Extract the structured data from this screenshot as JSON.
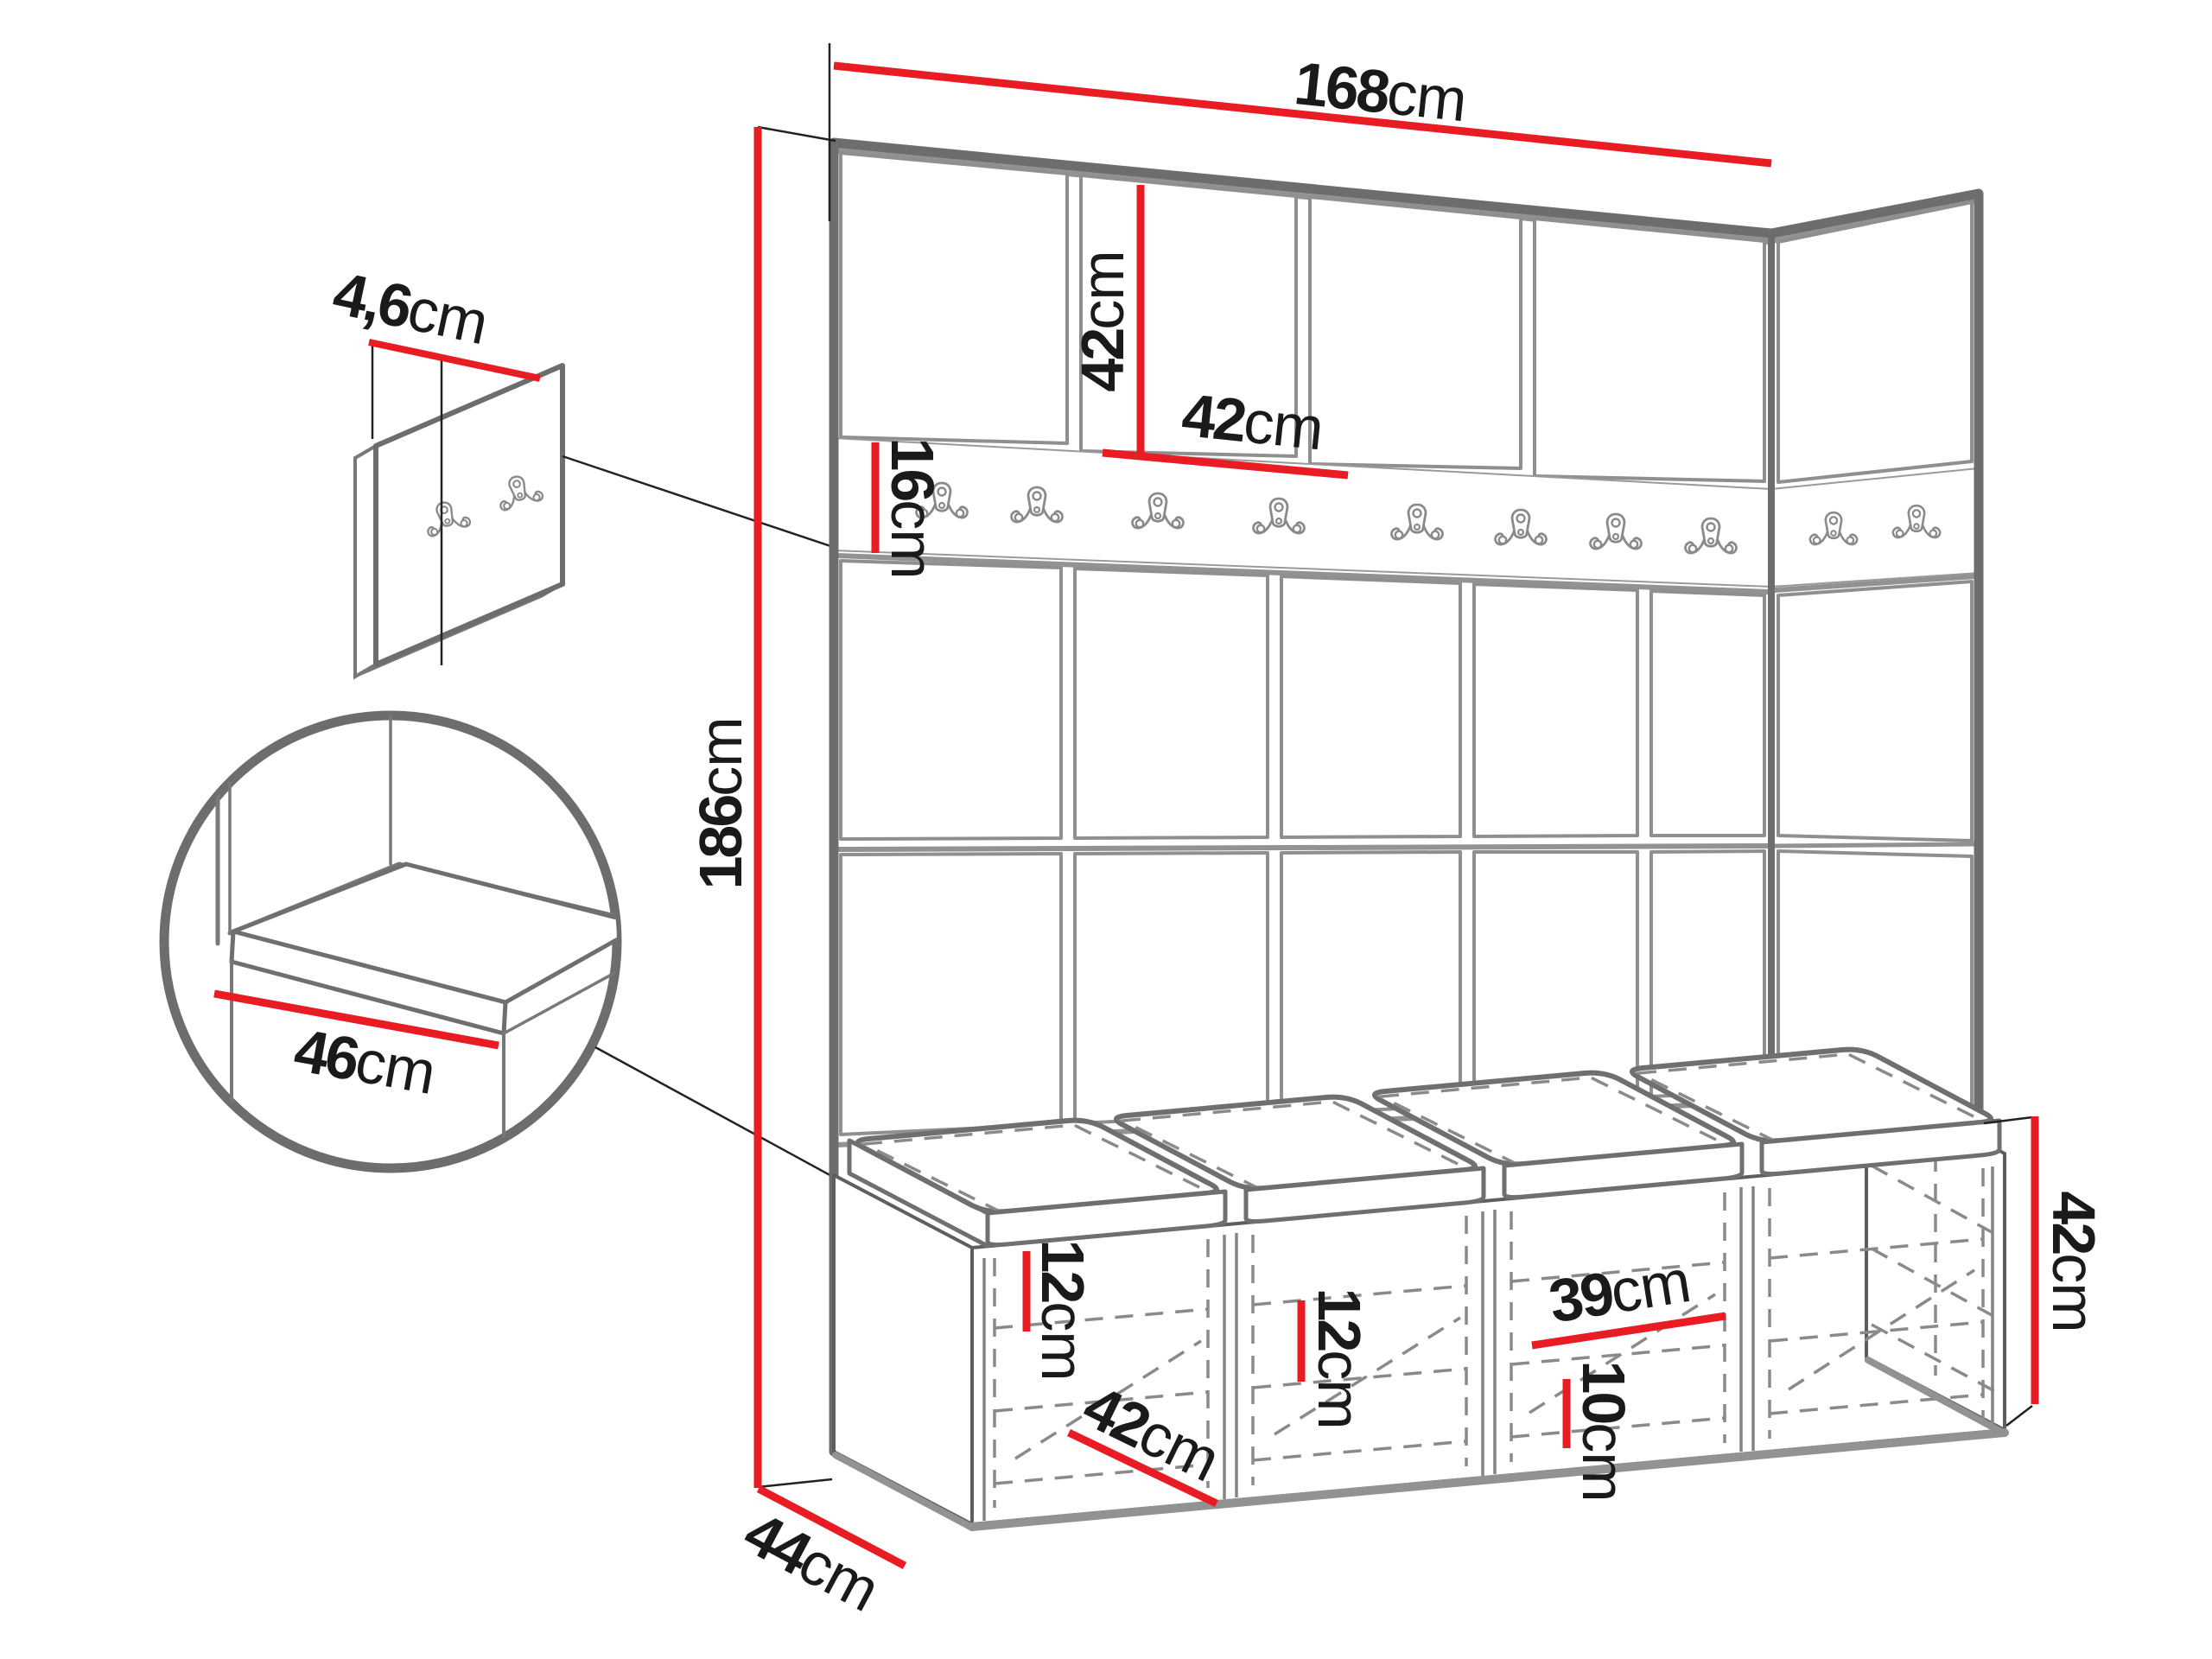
{
  "diagram": {
    "type": "furniture-dimension-drawing",
    "subject": "hallway wardrobe set with upholstered wall panels, hook rail, corner return and shoe storage bench",
    "unit": "cm"
  },
  "colors": {
    "dimension_red": "#e81c22",
    "outline_gray": "#8f8f8f",
    "frame_gray": "#6d6d6d",
    "cabinet_gray": "#5e5e5e",
    "dashed_gray": "#8a8a8a",
    "text_black": "#1a1a1a",
    "background": "#ffffff"
  },
  "counts": {
    "front_hooks": 8,
    "side_hooks": 2,
    "detail_panel_hooks": 2,
    "seat_cushions": 4,
    "storage_sections": 4
  },
  "dimensions": {
    "total_width": {
      "value": "168",
      "unit": "cm"
    },
    "total_height": {
      "value": "186",
      "unit": "cm"
    },
    "panel_height": {
      "value": "42",
      "unit": "cm"
    },
    "panel_width": {
      "value": "42",
      "unit": "cm"
    },
    "rail_height": {
      "value": "16",
      "unit": "cm"
    },
    "wall_panel_thickness": {
      "value": "4,6",
      "unit": "cm"
    },
    "seat_depth": {
      "value": "46",
      "unit": "cm"
    },
    "shelf_gap_left": {
      "value": "12",
      "unit": "cm"
    },
    "shelf_gap_middle": {
      "value": "12",
      "unit": "cm"
    },
    "compartment_depth": {
      "value": "42",
      "unit": "cm"
    },
    "compartment_width": {
      "value": "39",
      "unit": "cm"
    },
    "plinth_height": {
      "value": "10",
      "unit": "cm"
    },
    "bench_height": {
      "value": "42",
      "unit": "cm"
    },
    "unit_depth": {
      "value": "44",
      "unit": "cm"
    }
  }
}
